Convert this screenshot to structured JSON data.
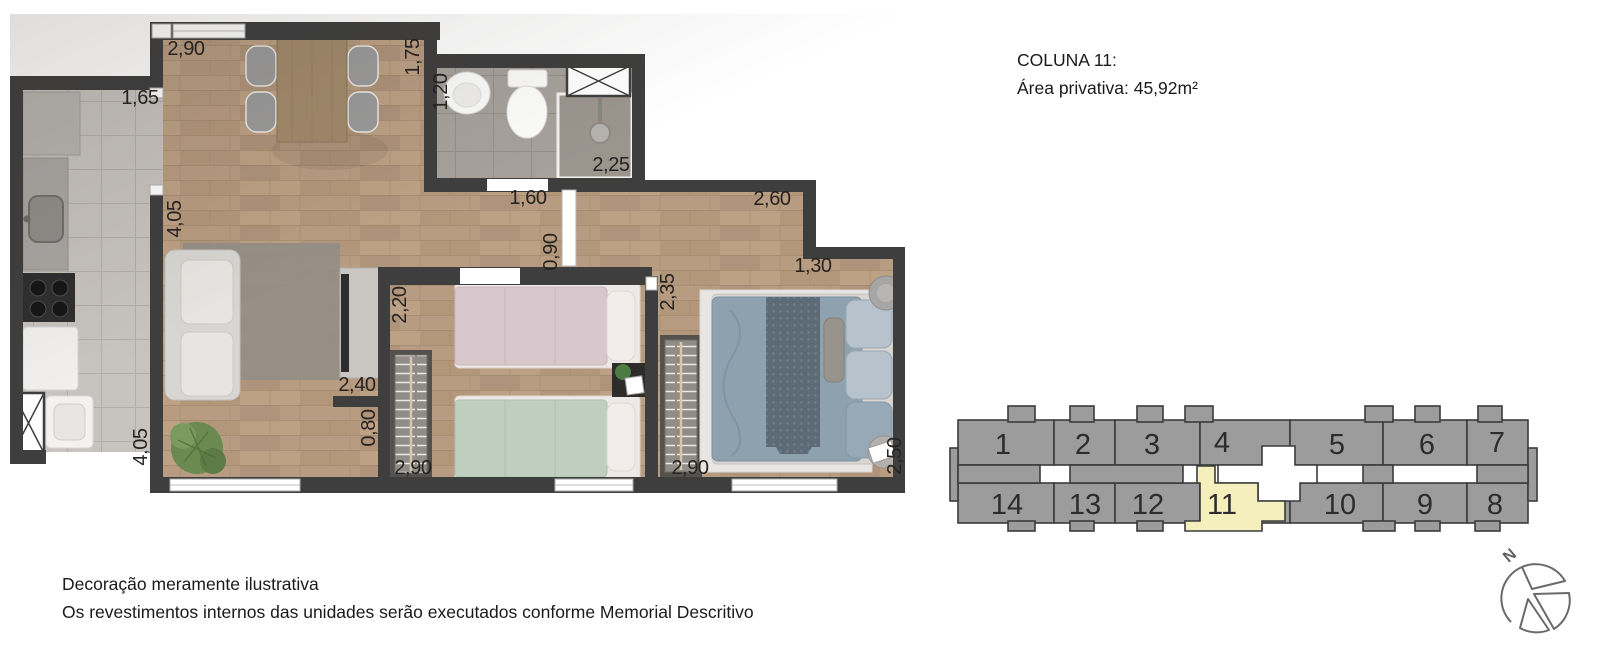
{
  "header": {
    "title": "COLUNA 11:",
    "subtitle": "Área privativa: 45,92m²"
  },
  "plan": {
    "measurements": [
      "2,90",
      "1,75",
      "1,65",
      "1,20",
      "2,25",
      "1,60",
      "2,60",
      "4,05",
      "0,90",
      "2,35",
      "1,30",
      "2,20",
      "2,40",
      "0,80",
      "4,05",
      "2,90",
      "2,90",
      "2,50"
    ]
  },
  "keyplan": {
    "highlighted_unit": "11",
    "top_row": [
      "1",
      "2",
      "3",
      "4",
      "5",
      "6",
      "7"
    ],
    "bottom_row": [
      "14",
      "13",
      "12",
      "11",
      "10",
      "9",
      "8"
    ],
    "colors": {
      "unit_fill": "#9c9c9c",
      "outline": "#3b3b3b",
      "highlight": "#f5efbe"
    }
  },
  "compass": {
    "north_label": "N"
  },
  "footer": {
    "line1": "Decoração meramente ilustrativa",
    "line2": "Os revestimentos internos das unidades serão executados conforme Memorial Descritivo"
  },
  "colors": {
    "wall": "#3e3e3e",
    "wood_floor": "#b69a7e",
    "tile_floor": "#c7c3be"
  }
}
